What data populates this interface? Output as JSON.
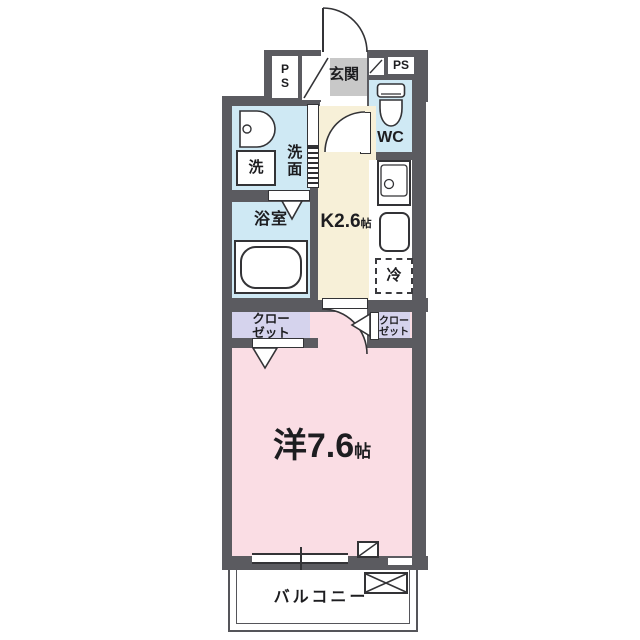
{
  "plan": {
    "type": "japanese-apartment-floor-plan"
  },
  "labels": {
    "ps_left_top": "P",
    "ps_left_bottom": "S",
    "ps_right": "PS",
    "entrance": "玄関",
    "toilet_room": "WC",
    "washroom": "洗面",
    "laundry": "洗",
    "bathroom": "浴室",
    "kitchen_size": "K2.6",
    "kitchen_unit": "帖",
    "fridge": "冷",
    "closet_left_line1": "クロー",
    "closet_left_line2": "ゼット",
    "closet_right_line1": "クロー",
    "closet_right_line2": "ゼット",
    "main_room_size": "洋7.6",
    "main_room_unit": "帖",
    "balcony": "バルコニー"
  },
  "colors": {
    "wall": "#5b5b60",
    "water_room_floor": "#cfe9f4",
    "kitchen_floor": "#f7f0d8",
    "main_room_floor": "#fadde4",
    "closet_floor": "#d5d3ed",
    "entrance_floor": "#c8c8c8",
    "line": "#333336",
    "balcony_line": "#55555a"
  },
  "icons": [
    "entrance-door-arc",
    "wc-door-arc",
    "room-door-arc",
    "toilet-icon",
    "washbasin-icon",
    "bathtub-icon",
    "kitchen-sink-icon",
    "counter-icon",
    "refrigerator-dashed-box",
    "pipe-shaft-diagonal-box",
    "sliding-door",
    "sliding-window",
    "balcony-equipment-crossbox",
    "door-swing-triangle"
  ]
}
